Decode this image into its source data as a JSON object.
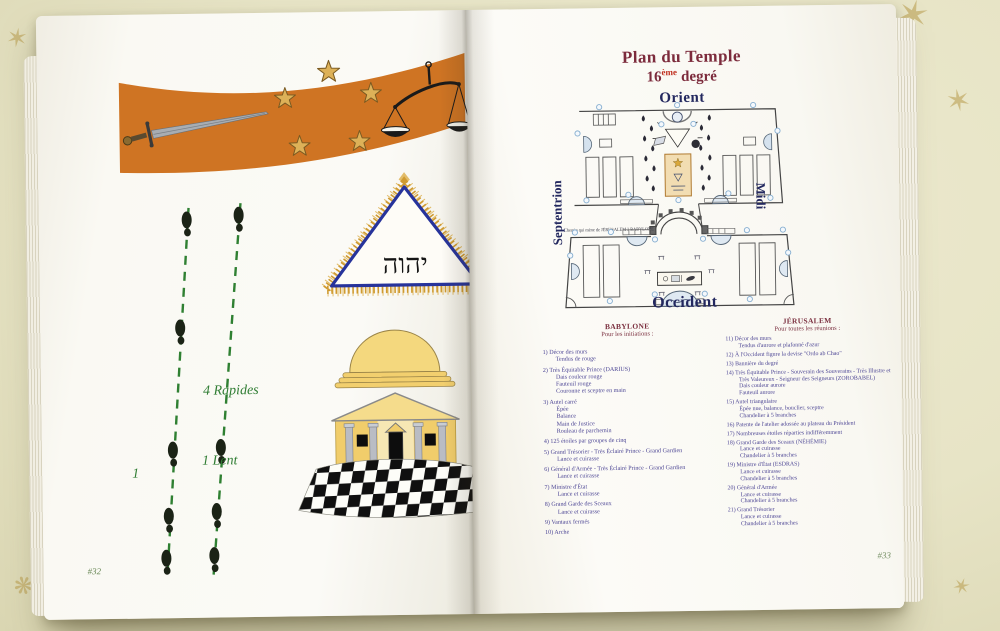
{
  "colors": {
    "banner_orange": "#cf7423",
    "star_gold": "#ddb158",
    "title_maroon": "#7c2b3c",
    "degree_sup_red": "#c03020",
    "compass_navy": "#23285f",
    "list_indigo": "#4c4594",
    "header_red": "#7b2f3f",
    "trail_green": "#2f7d33",
    "triangle_blue": "#27339b",
    "temple_gold": "#f1cd6b"
  },
  "left_page": {
    "page_number": "#32",
    "trail": {
      "rapides_label": "4 Rapides",
      "lent_label": "1 Lent",
      "start_label": "1"
    },
    "triangle_hebrew": "יהוה"
  },
  "right_page": {
    "page_number": "#33",
    "title": "Plan du Temple",
    "degree": {
      "number": "16",
      "sup": "ème",
      "word": "degré"
    },
    "compass": {
      "north": "Orient",
      "west": "Septentrion",
      "east": "Midi",
      "south": "Occident"
    },
    "plan_path_label": "Chemin qui mène de JÉRUSALEM à BABYLONE",
    "babylone": {
      "title": "BABYLONE",
      "subtitle": "Pour les initiations :",
      "items": [
        {
          "num": "1)",
          "lines": [
            "Décor des murs",
            "Tendus de rouge"
          ]
        },
        {
          "num": "2)",
          "lines": [
            "Très Équitable Prince (DARIUS)",
            "Dais couleur rouge",
            "Fauteuil rouge",
            "Couronne et sceptre en main"
          ]
        },
        {
          "num": "3)",
          "lines": [
            "Autel carré",
            "Épée",
            "Balance",
            "Main de Justice",
            "Rouleau de parchemin"
          ]
        },
        {
          "num": "4)",
          "lines": [
            "125 étoiles par groupes de cinq"
          ]
        },
        {
          "num": "5)",
          "lines": [
            "Grand Trésorier - Très Éclairé Prince - Grand Gardien",
            "Lance et cuirasse"
          ]
        },
        {
          "num": "6)",
          "lines": [
            "Général d'Armée - Très Éclairé Prince - Grand Gardien",
            "Lance et cuirasse"
          ]
        },
        {
          "num": "7)",
          "lines": [
            "Ministre d'État",
            "Lance et cuirasse"
          ]
        },
        {
          "num": "8)",
          "lines": [
            "Grand Garde des Sceaux",
            "Lance et cuirasse"
          ]
        },
        {
          "num": "9)",
          "lines": [
            "Vantaux fermés"
          ]
        },
        {
          "num": "10)",
          "lines": [
            "Arche"
          ]
        }
      ]
    },
    "jerusalem": {
      "title": "JÉRUSALEM",
      "subtitle": "Pour toutes les réunions :",
      "items": [
        {
          "num": "11)",
          "lines": [
            "Décor des murs",
            "Tendus d'aurore et plafonné d'azur"
          ]
        },
        {
          "num": "12)",
          "lines": [
            "À l'Occident figure la devise \"Ordo ab Chao\""
          ]
        },
        {
          "num": "13)",
          "lines": [
            "Bannière du degré"
          ]
        },
        {
          "num": "14)",
          "lines": [
            "Très Équitable Prince - Souverain des Souverains - Très Illustre et",
            "Très Valeureux - Seigneur des Seigneurs (ZOROBABEL)",
            "Dais couleur aurore",
            "Fauteuil aurore"
          ]
        },
        {
          "num": "15)",
          "lines": [
            "Autel triangulaire",
            "Épée nue, balance, bouclier, sceptre",
            "Chandelier à 5 branches"
          ]
        },
        {
          "num": "16)",
          "lines": [
            "Patente de l'atelier adossée au plateau du Président"
          ]
        },
        {
          "num": "17)",
          "lines": [
            "Nombreuses étoiles réparties indifféremment"
          ]
        },
        {
          "num": "18)",
          "lines": [
            "Grand Garde des Sceaux (NÉHÉMIE)",
            "Lance et cuirasse",
            "Chandelier à 5 branches"
          ]
        },
        {
          "num": "19)",
          "lines": [
            "Ministre d'État (ESDRAS)",
            "Lance et cuirasse",
            "Chandelier à 5 branches"
          ]
        },
        {
          "num": "20)",
          "lines": [
            "Général d'Armée",
            "Lance et cuirasse",
            "Chandelier à 5 branches"
          ]
        },
        {
          "num": "21)",
          "lines": [
            "Grand Trésorier",
            "Lance et cuirasse",
            "Chandelier à 5 branches"
          ]
        }
      ]
    }
  }
}
